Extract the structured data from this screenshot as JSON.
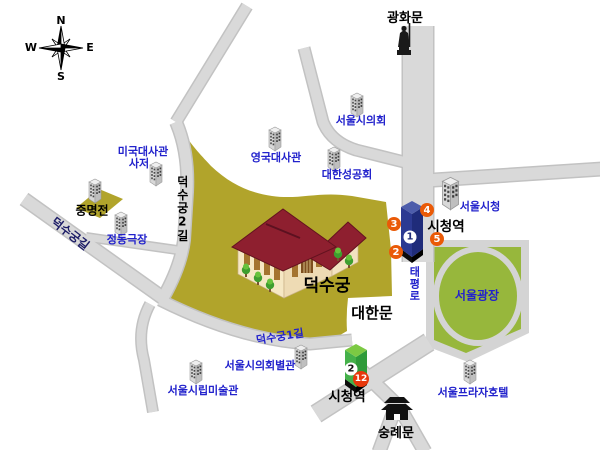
{
  "colors": {
    "road-fill": "#d9d9d9",
    "road-edge": "#c2c2c2",
    "palace-yellow": "#b1a42b",
    "plaza-green": "#97b73c",
    "label-blue": "#2222cc",
    "label-navy": "#1b1b66",
    "badge-orange": "#ea5a07",
    "badge-red": "#e8380c",
    "line1-blue": "#2c3a92",
    "line1-dark": "#1f2c7a",
    "line1-top": "#4d5dab",
    "line2-green": "#45b14a",
    "line2-dark": "#2f9b3a",
    "line2-top": "#7cc943",
    "roof-red": "#8e1f2f",
    "wall-cream": "#f6e8c4"
  },
  "compass": {
    "n": "N",
    "e": "E",
    "s": "S",
    "w": "W"
  },
  "labels": {
    "gwanghwamun": "광화문",
    "seoul_council": "서울시의회",
    "us_embassy_1": "미국대사관",
    "us_embassy_2": "사저",
    "uk_embassy": "영국대사관",
    "anglican_church": "대한성공회",
    "jungmyeongjeon": "중명전",
    "jeongdong_theater": "정동극장",
    "deoksugung_gil": "덕수궁길",
    "deoksugung_2gil": "덕수궁2길",
    "deoksugung": "덕수궁",
    "daehanmun": "대한문",
    "deoksugung_1gil": "덕수궁1길",
    "council_annex": "서울시의회별관",
    "seoul_museum_of_art": "서울시립미술관",
    "taepyeongro": "태평로",
    "seoul_plaza": "서울광장",
    "seoul_city_hall": "서울시청",
    "city_hall_station_east": "시청역",
    "city_hall_station_south": "시청역",
    "plaza_hotel": "서울프라자호텔",
    "sungnyemun": "숭례문"
  },
  "stations": {
    "line1_badge": "1",
    "line2_badge": "2",
    "exits": {
      "exit2": "2",
      "exit3": "3",
      "exit4": "4",
      "exit5": "5",
      "exit12": "12"
    }
  }
}
